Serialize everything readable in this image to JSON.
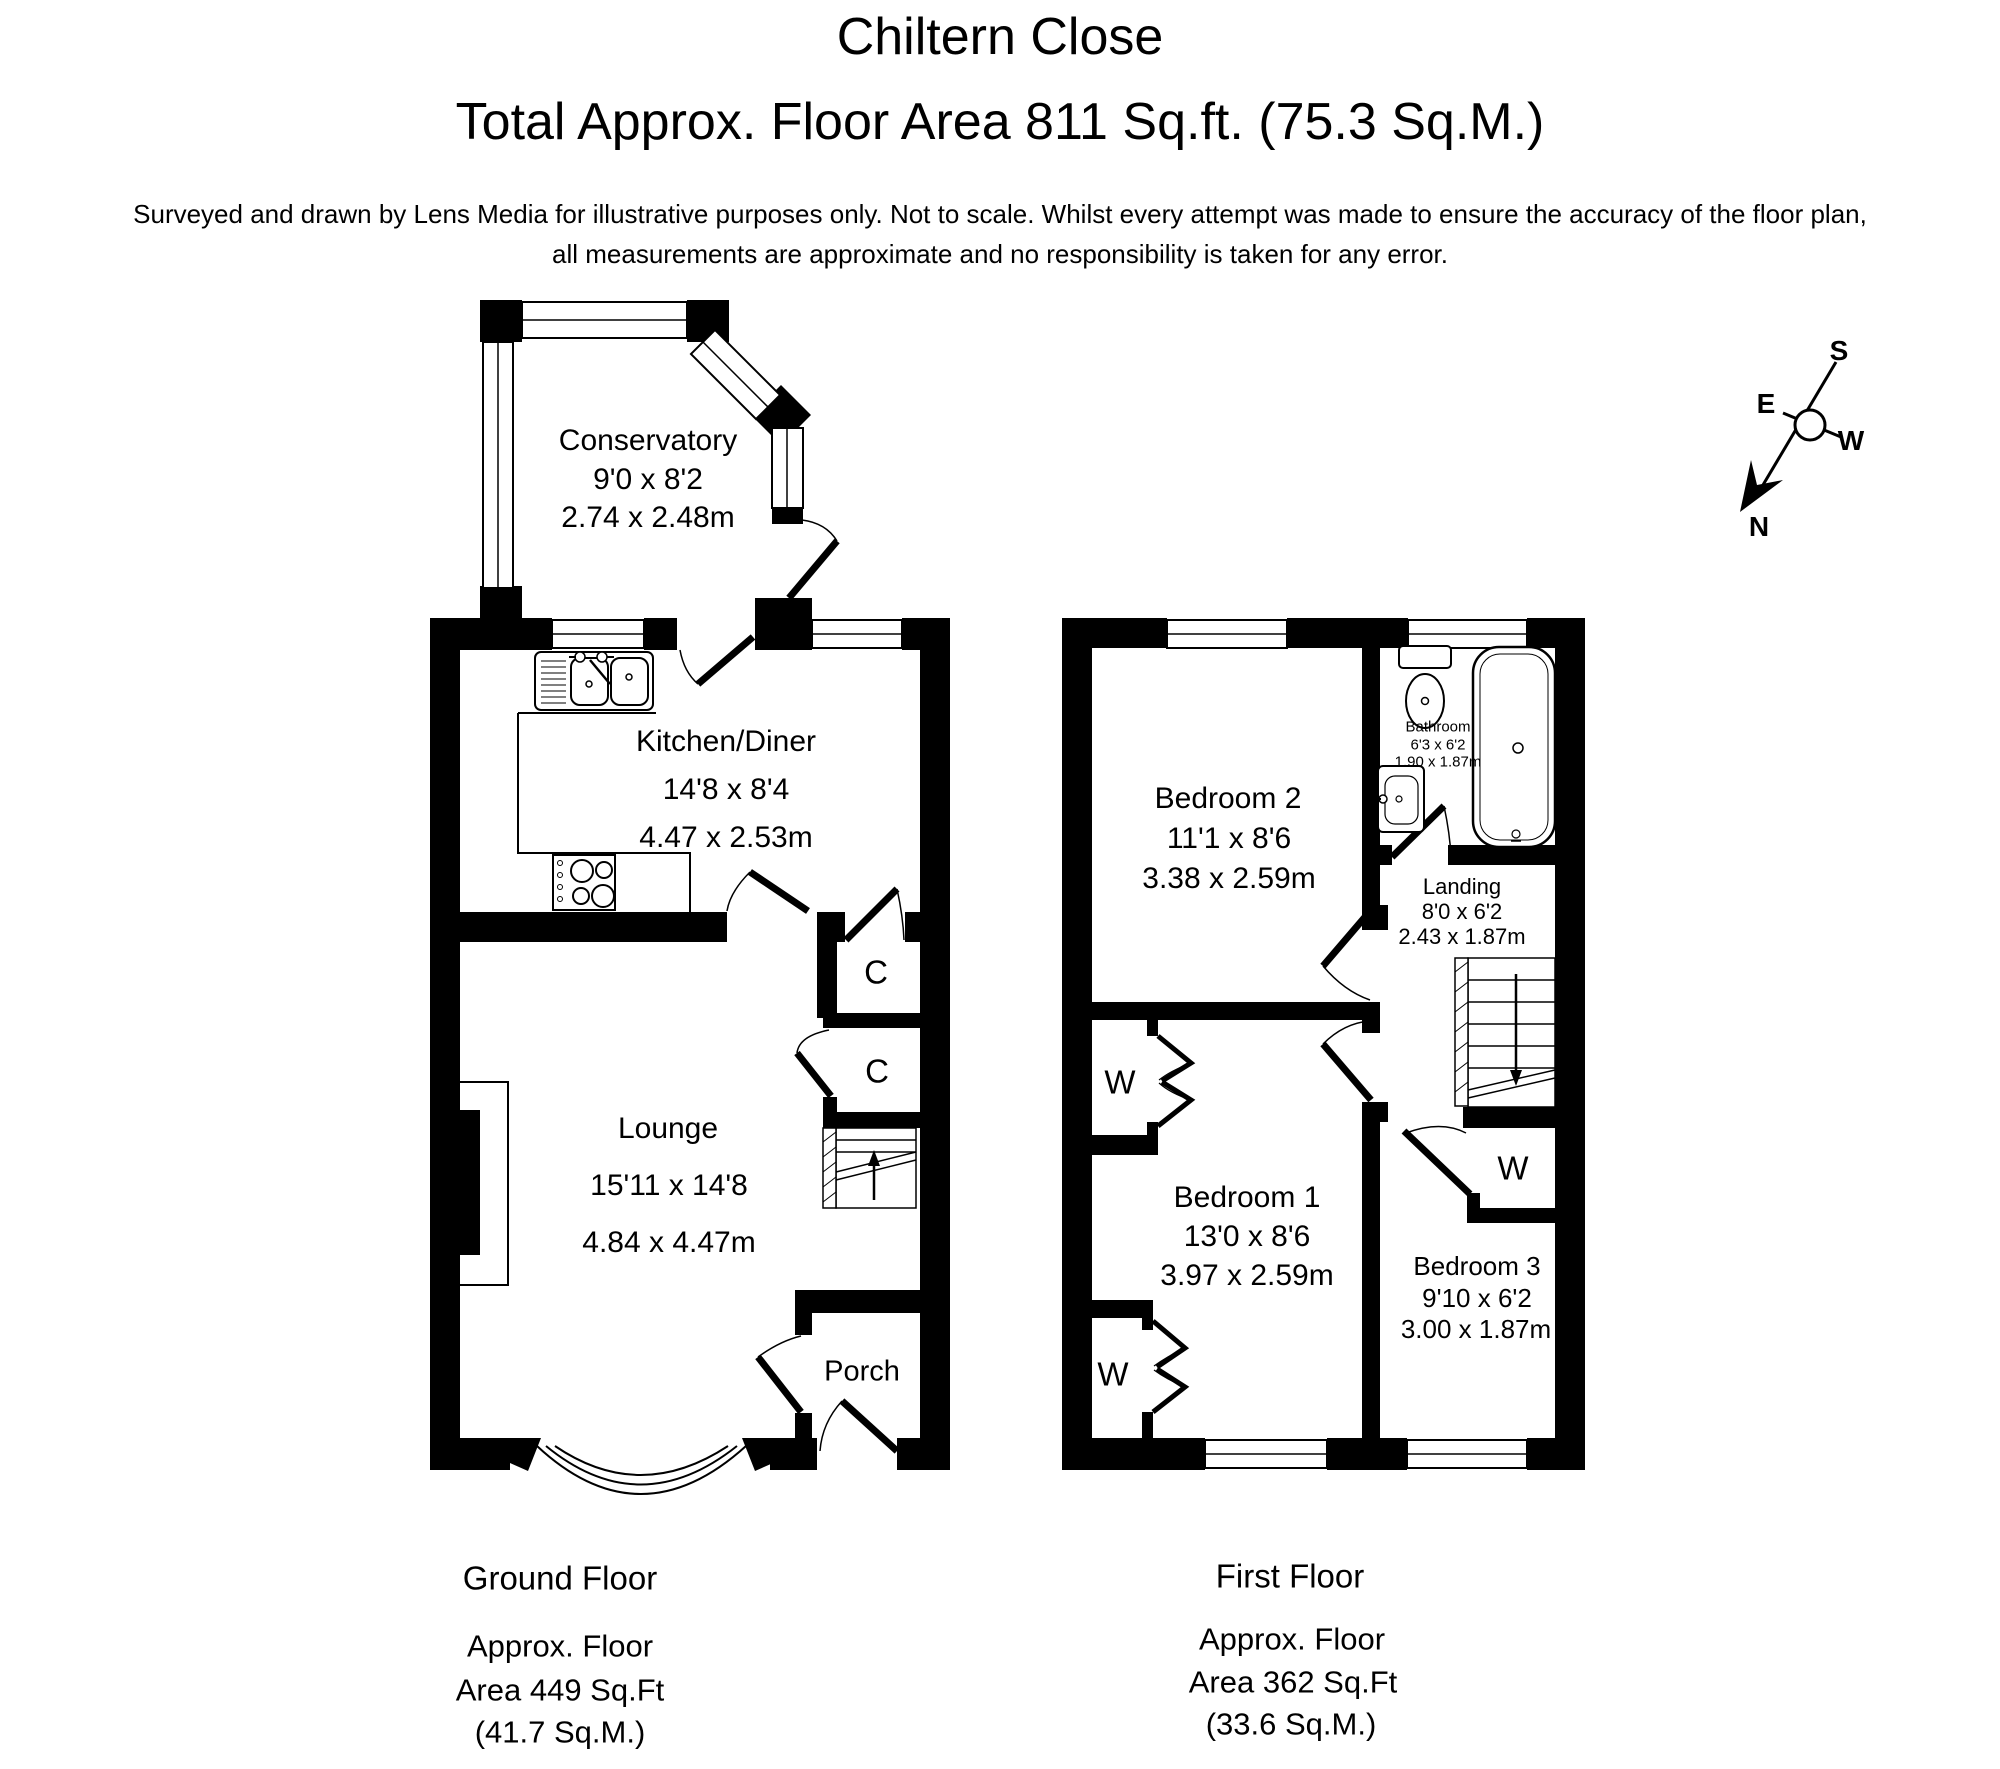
{
  "header": {
    "title": "Chiltern Close",
    "subtitle": "Total Approx. Floor Area 811 Sq.ft. (75.3 Sq.M.)",
    "disclaimer1": "Surveyed and drawn by Lens Media for illustrative purposes only. Not to scale. Whilst every attempt was made to ensure the accuracy of the floor plan,",
    "disclaimer2": "all measurements are approximate and no responsibility is taken for any error."
  },
  "compass": {
    "n": "N",
    "e": "E",
    "s": "S",
    "w": "W"
  },
  "colors": {
    "ink": "#000000",
    "paper": "#ffffff"
  },
  "ground_floor": {
    "floor_label": "Ground Floor",
    "area": [
      "Approx. Floor",
      "Area 449 Sq.Ft",
      "(41.7 Sq.M.)"
    ],
    "conservatory": [
      "Conservatory",
      "9'0 x 8'2",
      "2.74 x 2.48m"
    ],
    "kitchen": [
      "Kitchen/Diner",
      "14'8 x 8'4",
      "4.47 x 2.53m"
    ],
    "lounge": [
      "Lounge",
      "15'11 x 14'8",
      "4.84 x 4.47m"
    ],
    "porch": "Porch",
    "cupboard_top": "C",
    "cupboard_bottom": "C"
  },
  "first_floor": {
    "floor_label": "First Floor",
    "area": [
      "Approx. Floor",
      "Area 362 Sq.Ft",
      "(33.6 Sq.M.)"
    ],
    "bedroom2": [
      "Bedroom 2",
      "11'1 x 8'6",
      "3.38 x 2.59m"
    ],
    "bathroom": [
      "Bathroom",
      "6'3 x 6'2",
      "1.90 x 1.87m"
    ],
    "landing": [
      "Landing",
      "8'0 x 6'2",
      "2.43 x 1.87m"
    ],
    "bedroom1": [
      "Bedroom 1",
      "13'0 x 8'6",
      "3.97 x 2.59m"
    ],
    "bedroom3": [
      "Bedroom 3",
      "9'10 x 6'2",
      "3.00 x 1.87m"
    ],
    "wardrobe_b1_top": "W",
    "wardrobe_b1_bottom": "W",
    "wardrobe_b3": "W"
  }
}
